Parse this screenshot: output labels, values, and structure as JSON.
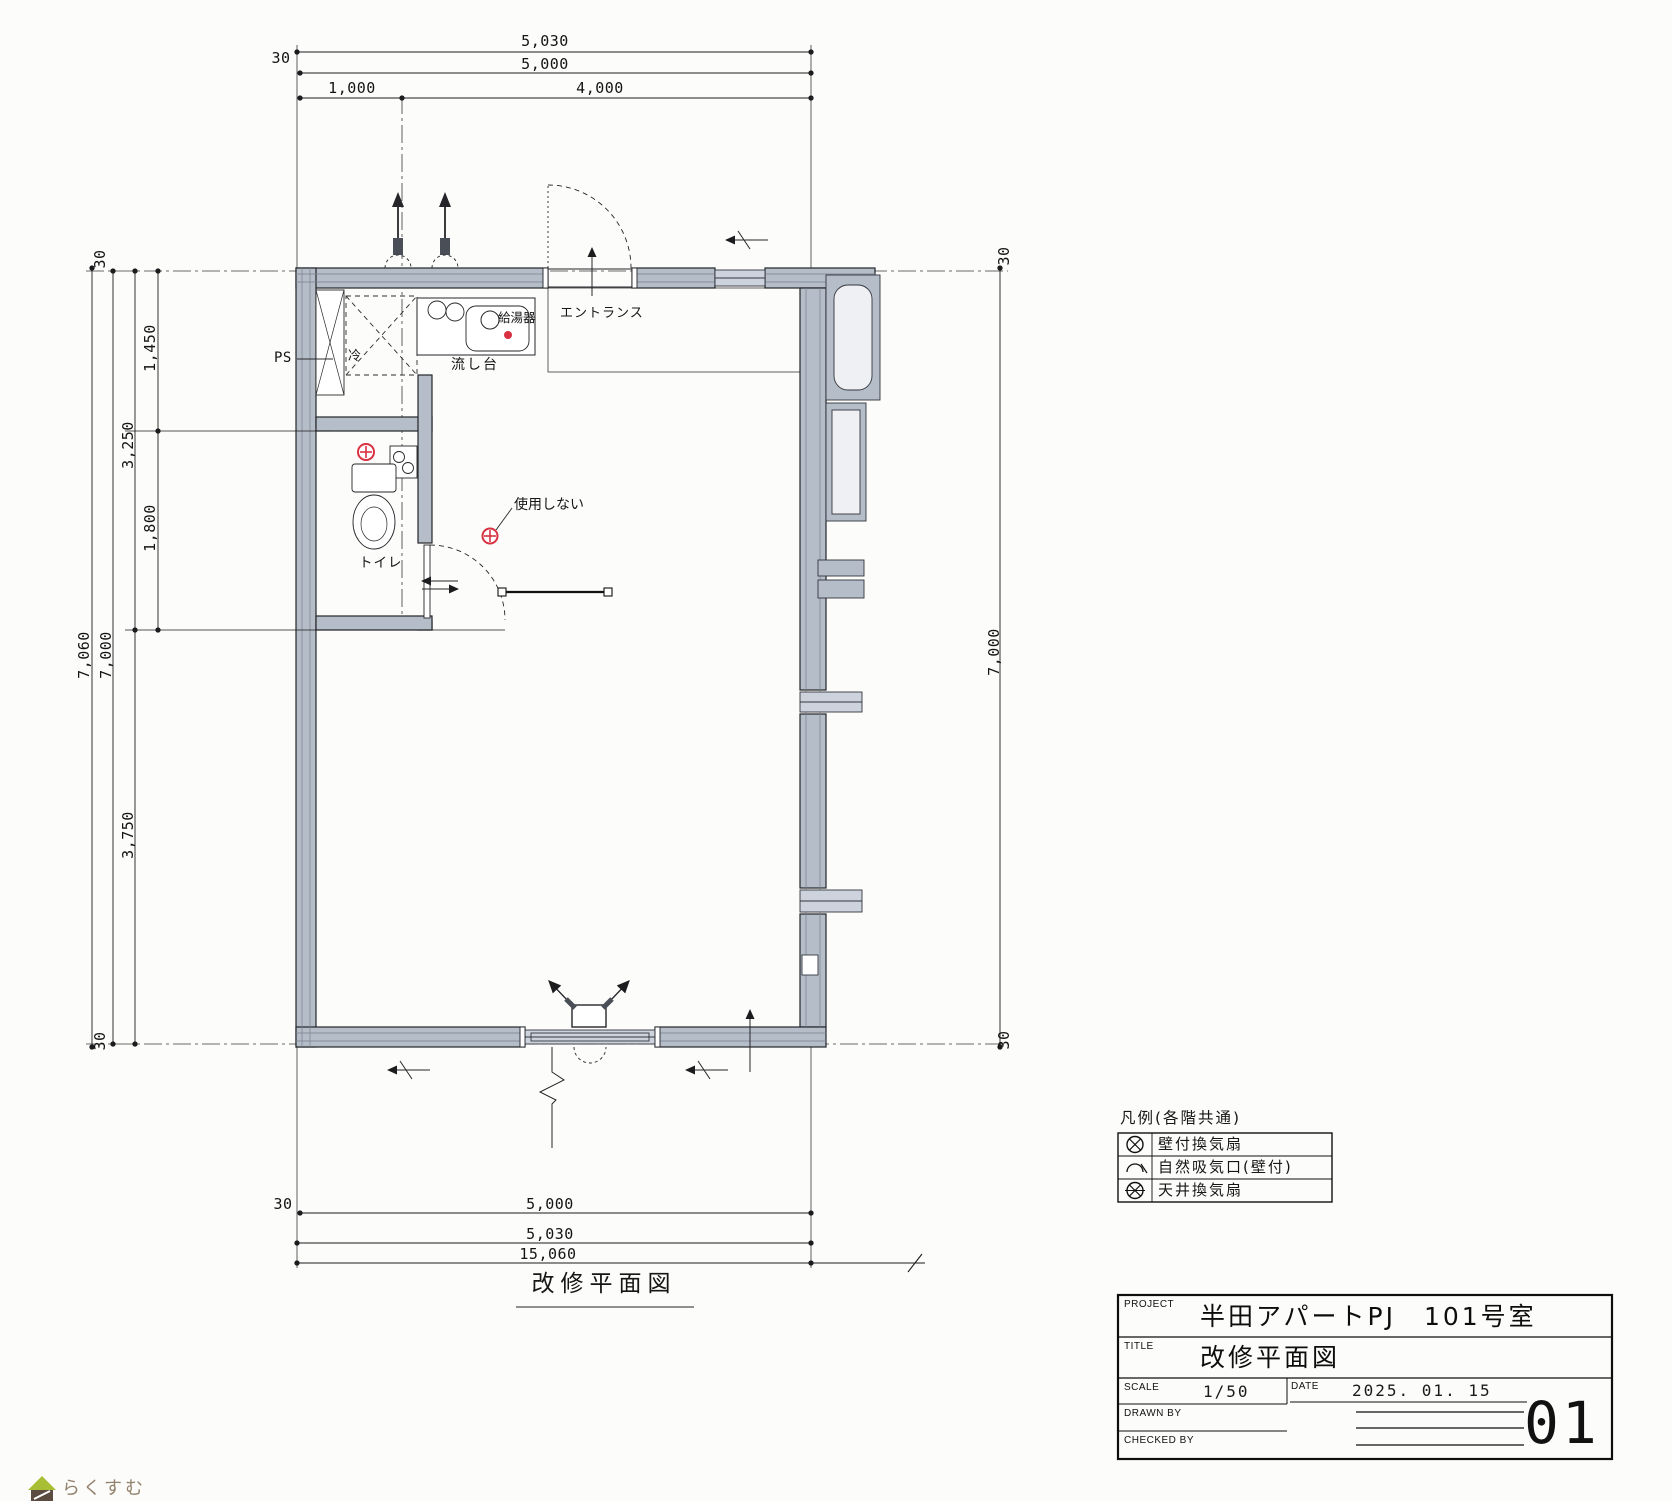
{
  "colors": {
    "paper": "#fcfcfa",
    "line": "#1c1c1e",
    "wall_fill": "#b5bdc9",
    "wall_detail": "#79828f",
    "glazing": "#cdd3dc",
    "symbol_red": "#d93142",
    "logo_green": "#a8bf35",
    "logo_brown": "#5c4b41"
  },
  "plan": {
    "caption": "改修平面図",
    "labels": {
      "ps": "PS",
      "fridge": "冷",
      "water_heater": "給湯器",
      "sink_unit": "流し台",
      "entrance": "エントランス",
      "do_not_use": "使用しない",
      "toilet": "トイレ"
    },
    "dims": {
      "offset": "30",
      "top_outer": "5,030",
      "top_inner": "5,000",
      "top_seg_left": "1,000",
      "top_seg_right": "4,000",
      "left_outer": "7,060",
      "left_inner": "7,000",
      "left_upper": "1,450",
      "left_upper_group": "3,250",
      "left_mid": "1,800",
      "left_lower": "3,750",
      "right_inner": "7,000",
      "bottom_inner": "5,000",
      "bottom_outer": "5,030",
      "bottom_overall": "15,060"
    }
  },
  "legend": {
    "title": "凡例(各階共通)",
    "rows": [
      {
        "symbol": "wall-fan-icon",
        "label": "壁付換気扇"
      },
      {
        "symbol": "natural-intake-icon",
        "label": "自然吸気口(壁付)"
      },
      {
        "symbol": "ceiling-fan-icon",
        "label": "天井換気扇"
      }
    ]
  },
  "title_block": {
    "project_label": "PROJECT",
    "project": "半田アパートPJ　101号室",
    "title_label": "TITLE",
    "title": "改修平面図",
    "scale_label": "SCALE",
    "scale": "1/50",
    "date_label": "DATE",
    "date": "2025. 01. 15",
    "drawn_by_label": "DRAWN BY",
    "checked_by_label": "CHECKED BY",
    "sheet_number": "01"
  },
  "logo": {
    "text": "らくすむ"
  }
}
